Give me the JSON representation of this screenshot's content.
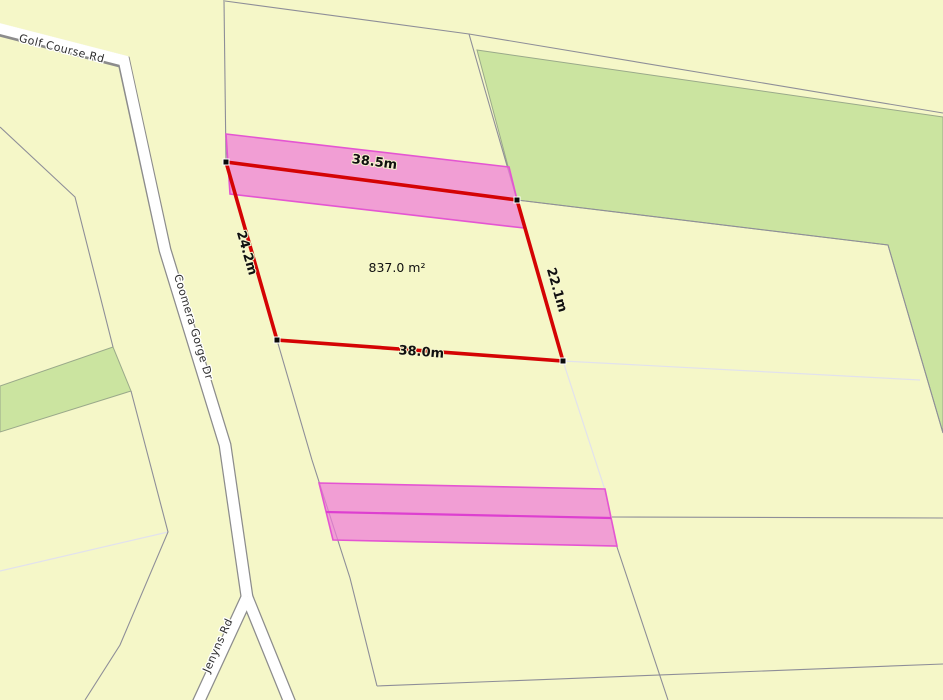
{
  "map": {
    "selected_parcel": {
      "area_label": "837.0 m²",
      "side_lengths": {
        "top": "38.5m",
        "left": "24.2m",
        "right": "22.1m",
        "bottom": "38.0m"
      }
    },
    "roads": {
      "golf_course": "Golf Course Rd",
      "coomera_gorge": "Coomera Gorge Dr",
      "jenyns": "Jenyns Rd"
    },
    "legend_semantics": {
      "red_outline": "measured parcel boundary",
      "pink_strips": "easement strips",
      "green_polygons": "vegetation / reserve parcels"
    },
    "colors": {
      "background_parcel_yellow": "#F5F7C8",
      "vegetation_green": "#CBE4A0",
      "road_fill": "#FFFFFF",
      "road_casing": "#8C8C8C",
      "parcel_boundary_gray": "#8E8E98",
      "faint_boundary": "#E2E2EC",
      "measure_red": "#D40404",
      "easement_pink_fill": "#F07CD8",
      "easement_pink_border": "#E455D2",
      "easement_pink_mid": "#DD3FD0",
      "label_text": "#101010"
    }
  }
}
